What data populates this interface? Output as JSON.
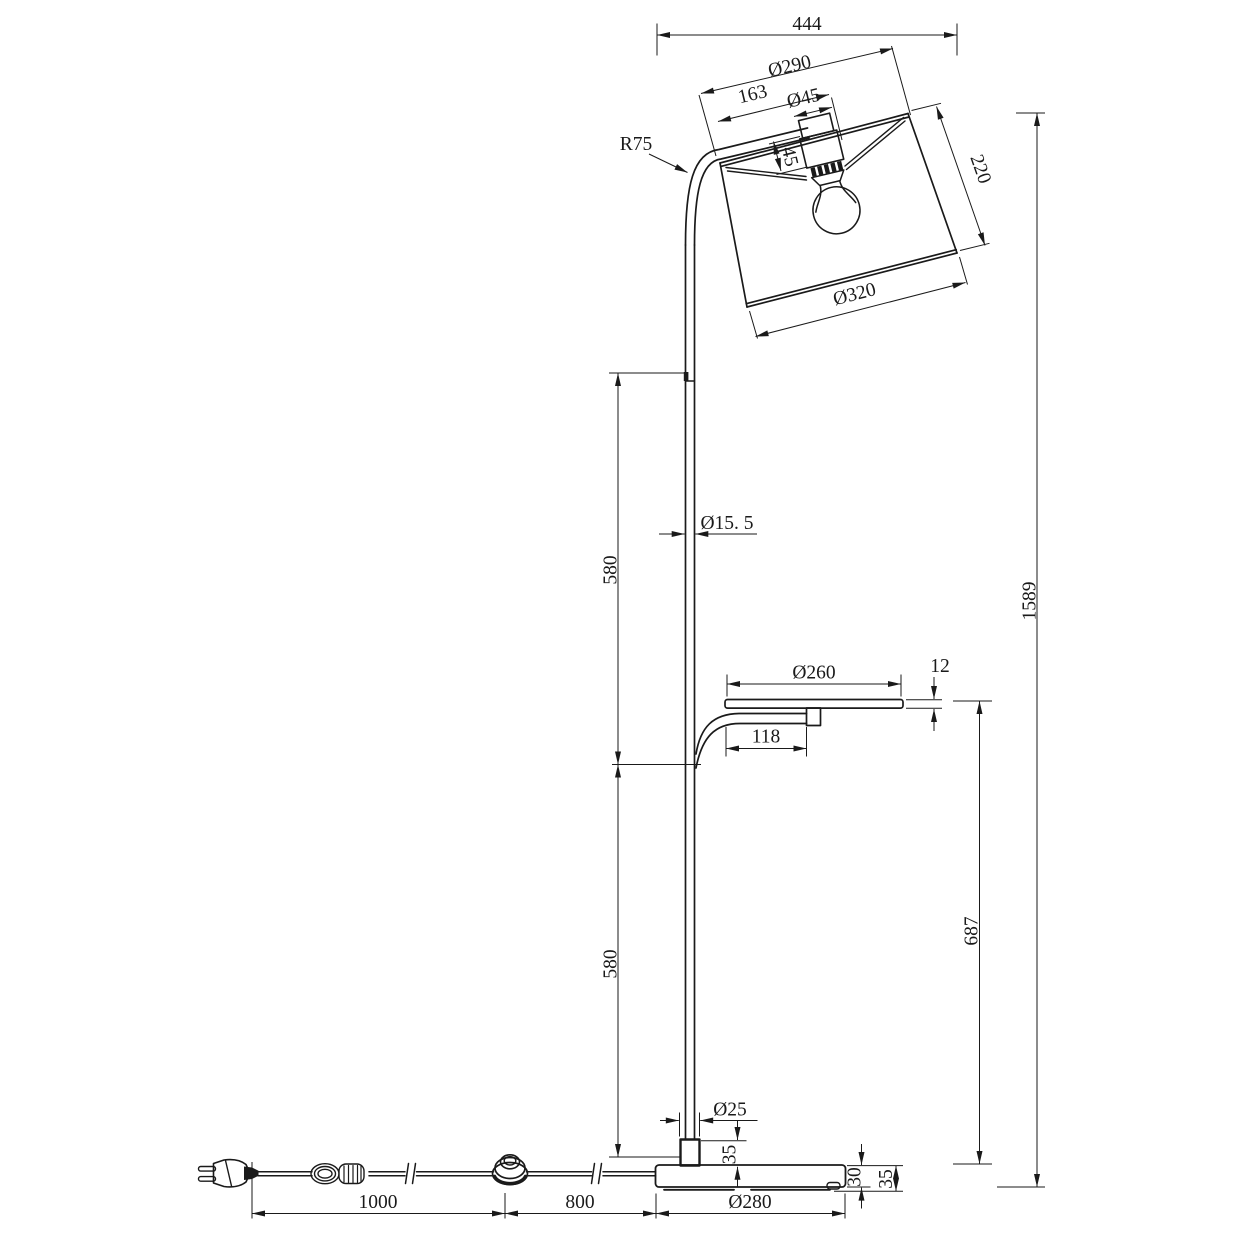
{
  "drawing": {
    "type": "technical dimension drawing",
    "subject": "arc floor lamp with drum shade, tray shelf, round base, inline foot switch and EU plug",
    "background_color": "#ffffff",
    "line_color": "#1a1a1a",
    "labels": {
      "overall_width": "444",
      "shade_top_diameter": "Ø290",
      "shade_fitter_width": "163",
      "socket_cap_diameter": "Ø45",
      "socket_cap_height": "45",
      "shade_height": "220",
      "arm_bend_radius": "R75",
      "shade_bottom_diameter": "Ø320",
      "pole_diameter": "Ø15. 5",
      "pole_upper_section_length": "580",
      "pole_lower_section_length": "580",
      "overall_height": "1589",
      "tray_diameter": "Ø260",
      "tray_thickness": "12",
      "tray_arm_length": "118",
      "tray_height_above_base": "687",
      "pole_socket_diameter": "Ø25",
      "pole_socket_height": "35",
      "base_thickness": "30",
      "base_total_height": "35",
      "cord_plug_to_switch_length": "1000",
      "cord_switch_to_base_length": "800",
      "base_diameter": "Ø280"
    }
  }
}
